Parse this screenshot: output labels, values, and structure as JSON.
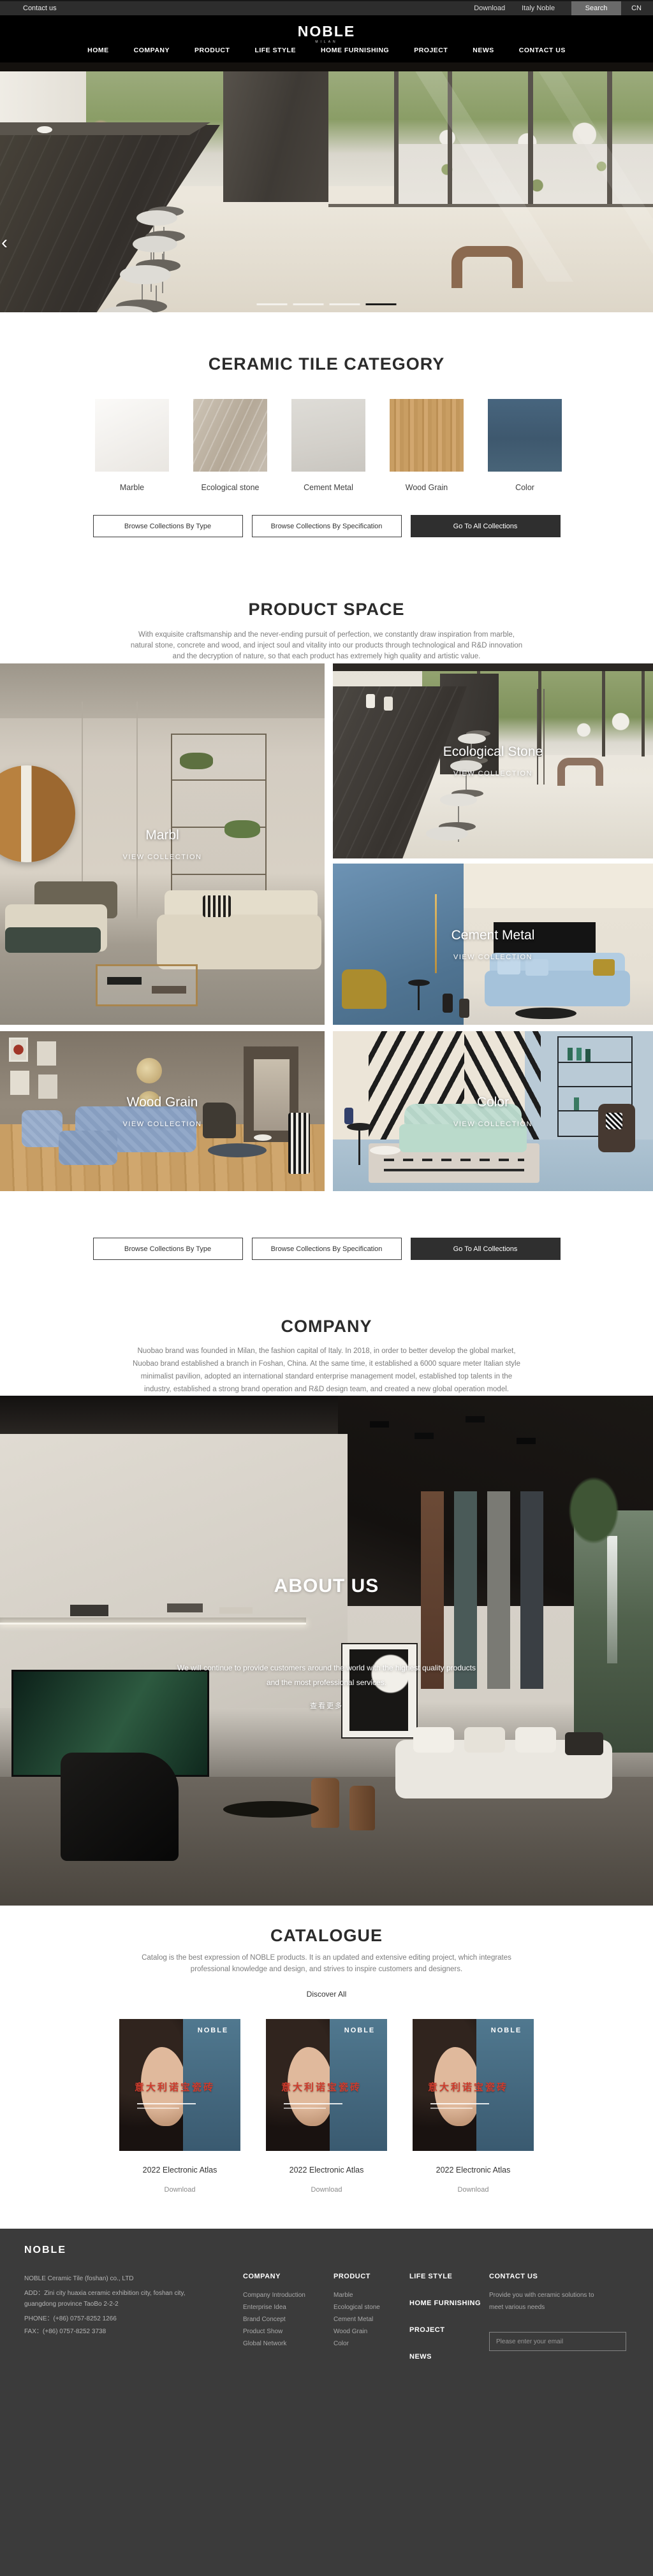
{
  "topbar": {
    "contact": "Contact us",
    "download": "Download",
    "italy": "Italy Noble",
    "search": "Search",
    "lang": "CN"
  },
  "header": {
    "logo": "NOBLE",
    "logo_sub": "MILAN",
    "nav": [
      "HOME",
      "COMPANY",
      "PRODUCT",
      "LIFE STYLE",
      "HOME FURNISHING",
      "PROJECT",
      "NEWS",
      "CONTACT US"
    ]
  },
  "hero": {
    "prev": "‹",
    "next": "›",
    "slide_count": 4,
    "active_slide": 4
  },
  "category": {
    "title": "CERAMIC TILE CATEGORY",
    "tiles": [
      {
        "label": "Marble"
      },
      {
        "label": "Ecological stone"
      },
      {
        "label": "Cement Metal"
      },
      {
        "label": "Wood Grain"
      },
      {
        "label": "Color"
      }
    ]
  },
  "buttons": {
    "by_type": "Browse Collections By Type",
    "by_spec": "Browse Collections By Specification",
    "all": "Go To All Collections"
  },
  "product_space": {
    "title": "PRODUCT SPACE",
    "lines": [
      "With exquisite craftsmanship and the never-ending pursuit of perfection, we constantly draw inspiration from marble,",
      "natural stone, concrete and wood, and inject soul and vitality into our products through technological and R&D innovation",
      "and the decryption of nature, so that each product has extremely high quality and artistic value."
    ],
    "cards": [
      {
        "name": "Marbl",
        "cta": "VIEW COLLECTION"
      },
      {
        "name": "Ecological Stone",
        "cta": "VIEW COLLECTION"
      },
      {
        "name": "Cement Metal",
        "cta": "VIEW COLLECTION"
      },
      {
        "name": "Wood Grain",
        "cta": "VIEW COLLECTION"
      },
      {
        "name": "Color",
        "cta": "VIEW COLLECTION"
      }
    ]
  },
  "company": {
    "title": "COMPANY",
    "lines": [
      "Nuobao brand was founded in Milan, the fashion capital of Italy. In 2018, in order to better develop the global market,",
      "Nuobao brand established a branch in Foshan, China. At the same time, it established a 6000 square meter Italian style",
      "minimalist pavilion, adopted an international standard enterprise management model, established top talents in the",
      "industry, established a strong brand operation and R&D design team, and created a new global operation model."
    ]
  },
  "about": {
    "title": "ABOUT US",
    "lines": [
      "We will continue to provide customers around the world with the highest quality products",
      "and the most professional services."
    ],
    "more": "查看更多"
  },
  "catalogue": {
    "title": "CATALOGUE",
    "lines": [
      "Catalog is the best expression of NOBLE products. It is an updated and extensive editing project, which integrates",
      "professional knowledge and design, and strives to inspire customers and designers."
    ],
    "discover": "Discover All",
    "items": [
      {
        "brand": "NOBLE",
        "cn": "意大利诺宝瓷砖",
        "label": "2022 Electronic Atlas",
        "download": "Download"
      },
      {
        "brand": "NOBLE",
        "cn": "意大利诺宝瓷砖",
        "label": "2022 Electronic Atlas",
        "download": "Download"
      },
      {
        "brand": "NOBLE",
        "cn": "意大利诺宝瓷砖",
        "label": "2022 Electronic Atlas",
        "download": "Download"
      }
    ]
  },
  "footer": {
    "logo": "NOBLE",
    "company_name": "NOBLE Ceramic Tile (foshan) co., LTD",
    "address": "ADD：Zini city huaxia ceramic exhibition city, foshan city, guangdong province TaoBo 2-2-2",
    "phone": "PHONE：(+86) 0757-8252 1266",
    "fax": "FAX：(+86) 0757-8252 3738",
    "columns": [
      {
        "title": "COMPANY",
        "items": [
          "Company Introduction",
          "Enterprise Idea",
          "Brand Concept",
          "Product Show",
          "Global Network"
        ]
      },
      {
        "title": "PRODUCT",
        "items": [
          "Marble",
          "Ecological stone",
          "Cement Metal",
          "Wood Grain",
          "Color"
        ]
      }
    ],
    "links": [
      "LIFE STYLE",
      "HOME FURNISHING",
      "PROJECT",
      "NEWS"
    ],
    "contact": {
      "title": "CONTACT US",
      "desc": "Provide you with ceramic solutions to meet various needs",
      "placeholder": "Please enter your email"
    }
  }
}
